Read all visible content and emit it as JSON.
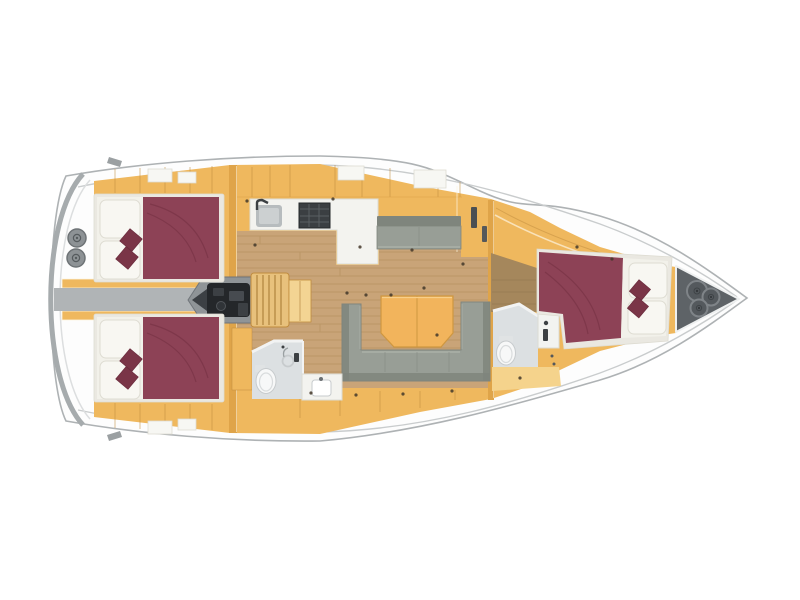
{
  "scene": {
    "type": "sailing-yacht-interior-floorplan-top-view",
    "orientation": "bow-right",
    "areas": [
      "stern-deck",
      "aft-cabin-port",
      "aft-cabin-starboard",
      "corridor",
      "engine-compartment",
      "companionway-steps",
      "galley",
      "salon",
      "aft-head",
      "forward-head",
      "forward-cabin",
      "anchor-locker",
      "bow-deck"
    ],
    "furnishings": [
      "stern-winch",
      "double-bed",
      "bed-pillows",
      "bed-cushions",
      "galley-sink",
      "galley-stove",
      "galley-counter",
      "chaise-bench",
      "salon-sofa",
      "salon-table",
      "toilet",
      "shower-ring",
      "shower-column",
      "washbasin",
      "anchor-hatch"
    ]
  },
  "palette": {
    "bg": "#ffffff",
    "hullFill": "#fdfdfd",
    "hullStroke": "#aeb2b4",
    "innerLine": "#c9cccd",
    "deckArc": "#a6abad",
    "deckArcLight": "#dcdedf",
    "cleat": "#9ba0a2",
    "winchFill": "#8d9295",
    "winchRing": "#6e7376",
    "winchDetail": "#565b5e",
    "tan": "#efb85e",
    "tanDark": "#dfa449",
    "tanLight": "#f5d38c",
    "tanLine": "#c08b3e",
    "tanHighlight": "#fdf4e0",
    "wood": "#c9a478",
    "woodLine": "#b08a58",
    "woodDark": "#a5875c",
    "woodDarkLine": "#8f744c",
    "burgundy": "#8d4256",
    "burgundyDark": "#7a3547",
    "mattress": "#f2f1ea",
    "pillow": "#f8f7f2",
    "pillowEdge": "#dedcd2",
    "bedFrame": "#eae8e1",
    "sofa": "#989e96",
    "sofaDark": "#7f857d",
    "sofaLight": "#aeb4ab",
    "table": "#f2b45c",
    "tableLine": "#cf9740",
    "tableHighlight": "#f8cf8a",
    "bath": "#dce0e2",
    "bathWall": "#f2f3f3",
    "fixture": "#f7f8f8",
    "fixtureEdge": "#c7cbcd",
    "fixtureTank": "#e0e3e4",
    "corridor": "#b0b4b6",
    "engineHouse": "#8f9497",
    "engineDark": "#24272a",
    "engineMid": "#3c4044",
    "steps": "#e8c17c",
    "stepsLine": "#b78c47",
    "stepLanding": "#f3d493",
    "locker": "#5e6367",
    "lockerRing": "#7f8488",
    "lockerCircle": "#54595d",
    "stove": "#3b3f42",
    "stoveGrid": "#5a5f62",
    "sink": "#b7bcbe",
    "sinkInner": "#ccd0d1",
    "counter": "#f3f3ef",
    "counterEdge": "#dbdbd4",
    "hatch": "#f7f7f3",
    "dot": "#43382a",
    "dark": "#3c4043"
  }
}
